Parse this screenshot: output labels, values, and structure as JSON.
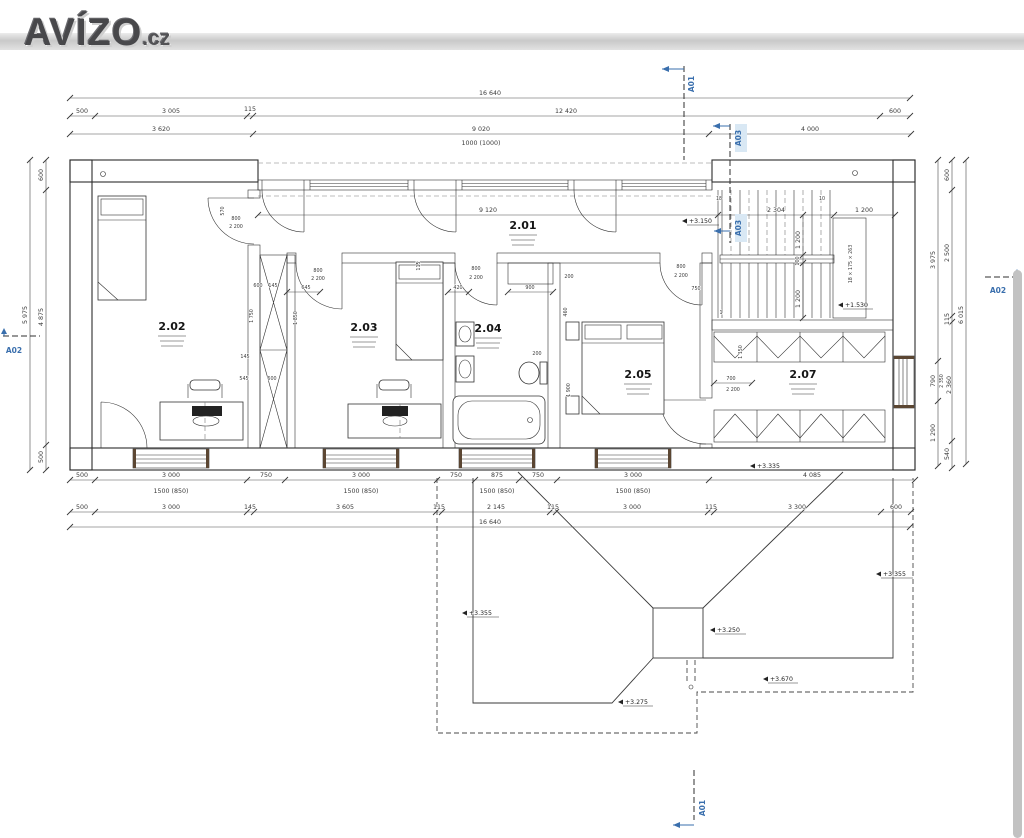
{
  "logo": {
    "brand": "AVÍZO",
    "tld": ".cz"
  },
  "colors": {
    "section_blue": "#3a6fad",
    "wall_fill": "#f5eed5",
    "hatch_line": "#ddcf9f",
    "partition": "#d7c7a2",
    "scrollbar": "#c2c2c2"
  },
  "d": {
    "t16640": "16 640",
    "n500": "500",
    "n3005": "3 005",
    "n115": "115",
    "n12420": "12 420",
    "n600": "600",
    "n3620": "3 620",
    "n9020": "9 020",
    "n4000": "4 000",
    "spec1000": "1000 (1000)",
    "n3000": "3 000",
    "n750": "750",
    "n875": "875",
    "n4085": "4 085",
    "w1500": "1500 (850)",
    "n145": "145",
    "n3605": "3 605",
    "n2145": "2 145",
    "n3300": "3 300",
    "n4875": "4 875",
    "n5975": "5 975",
    "n3975": "3 975",
    "n790": "790",
    "n1290": "1 290",
    "n2500": "2 500",
    "n2350": "2 350",
    "n2360": "2 360",
    "n540": "540",
    "n6015": "6 015",
    "n9120": "9 120",
    "n2304": "2 304",
    "n1200": "1 200",
    "n100": "100",
    "n570": "570",
    "n800": "800",
    "n2200": "2 200",
    "n645": "645",
    "n420": "420",
    "n900": "900",
    "n200": "200",
    "n460": "460",
    "n1900": "1 900",
    "n700": "700",
    "n1150": "1 150",
    "n1750": "1 750",
    "n1850": "1 850",
    "n545": "545"
  },
  "stairs": {
    "formula": "18 × 175 × 263",
    "n18": "18",
    "n10": "10",
    "n1": "1"
  },
  "levels": {
    "p3150": "+3.150",
    "p1530": "+1.530",
    "p3335": "+3.335",
    "p3355": "+3.355",
    "p3250": "+3.250",
    "p3275": "+3.275",
    "p3670": "+3.670"
  },
  "rooms": {
    "r201": "2.01",
    "r202": "2.02",
    "r203": "2.03",
    "r204": "2.04",
    "r205": "2.05",
    "r207": "2.07"
  },
  "sections": {
    "a01": "A01",
    "a02": "A02",
    "a03": "A03"
  }
}
